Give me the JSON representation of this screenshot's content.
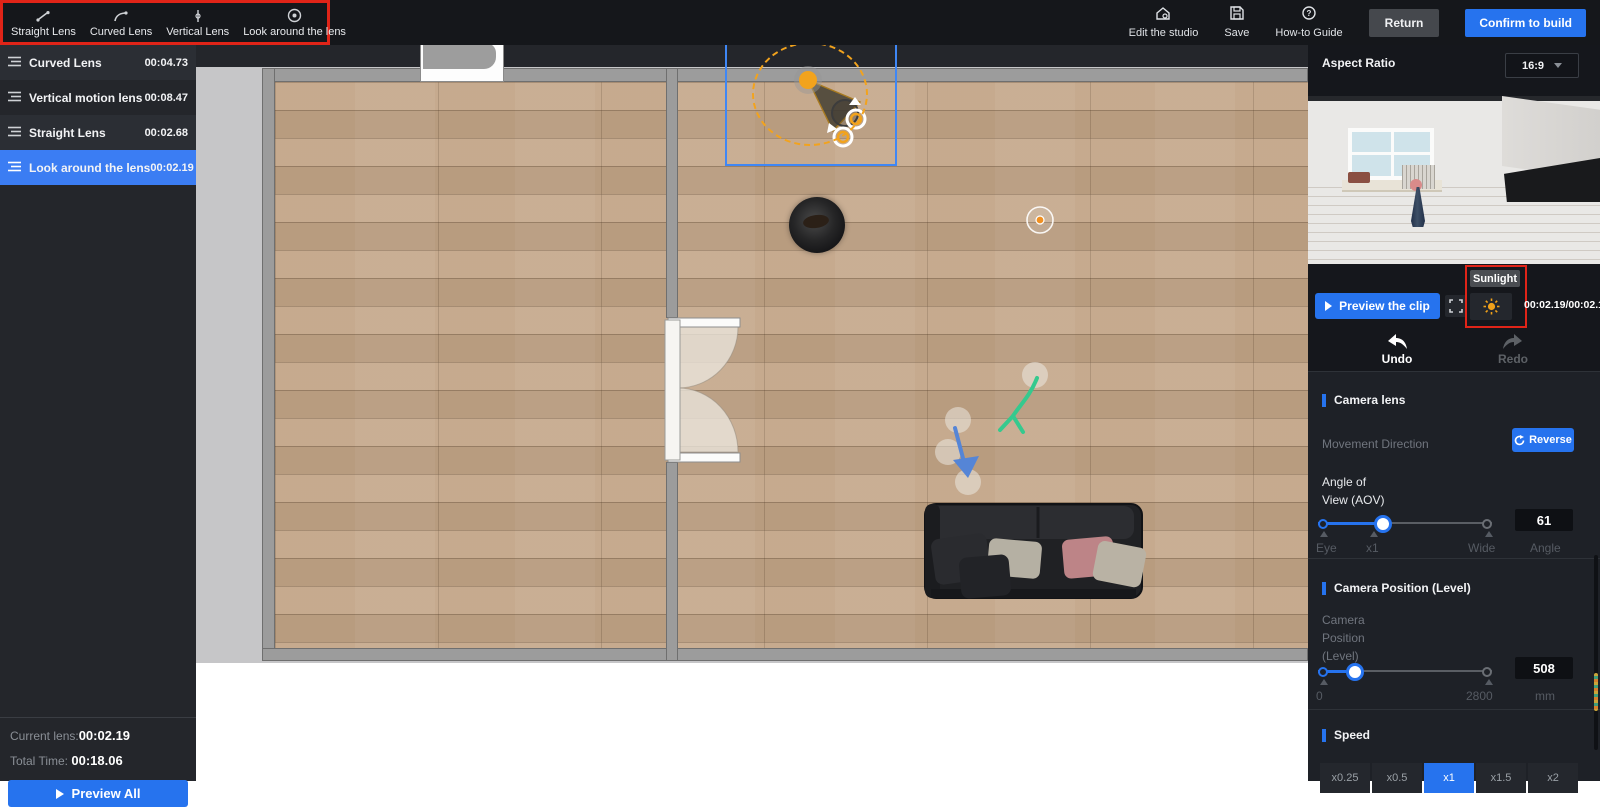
{
  "toolbar": {
    "lens_tools": [
      {
        "label": "Straight Lens"
      },
      {
        "label": "Curved Lens"
      },
      {
        "label": "Vertical Lens"
      },
      {
        "label": "Look around the lens"
      }
    ],
    "actions": [
      {
        "label": "Edit the studio"
      },
      {
        "label": "Save"
      },
      {
        "label": "How-to Guide"
      }
    ],
    "return_label": "Return",
    "confirm_label": "Confirm to build"
  },
  "sidebar": {
    "items": [
      {
        "label": "Curved Lens",
        "time": "00:04.73"
      },
      {
        "label": "Vertical motion lens",
        "time": "00:08.47"
      },
      {
        "label": "Straight Lens",
        "time": "00:02.68"
      },
      {
        "label": "Look around the lens",
        "time": "00:02.19"
      }
    ],
    "current_lens_label": "Current lens:",
    "current_lens_value": "00:02.19",
    "total_time_label": "Total Time:",
    "total_time_value": "00:18.06",
    "preview_all_label": "Preview All"
  },
  "panel": {
    "aspect_ratio_label": "Aspect Ratio",
    "aspect_ratio_value": "16:9",
    "preview_clip_label": "Preview the clip",
    "sunlight_tooltip": "Sunlight",
    "time_display": "00:02.19/00:02.19",
    "undo_label": "Undo",
    "redo_label": "Redo",
    "camera_lens_title": "Camera lens",
    "movement_direction_label": "Movement Direction",
    "reverse_label": "Reverse",
    "aov_label_line1": "Angle of",
    "aov_label_line2": "View (AOV)",
    "aov_min_label": "Eye",
    "aov_mid_label": "x1",
    "aov_max_label": "Wide",
    "aov_value": "61",
    "aov_unit_label": "Angle",
    "camera_position_title": "Camera Position (Level)",
    "camera_position_label_line1": "Camera",
    "camera_position_label_line2": "Position",
    "camera_position_label_line3": "(Level)",
    "camera_position_min": "0",
    "camera_position_max": "2800",
    "camera_position_value": "508",
    "camera_position_unit": "mm",
    "speed_title": "Speed",
    "speed_options": [
      {
        "label": "x0.25"
      },
      {
        "label": "x0.5"
      },
      {
        "label": "x1"
      },
      {
        "label": "x1.5"
      },
      {
        "label": "x2"
      }
    ]
  },
  "colors": {
    "accent_blue": "#2673ee",
    "selected_row_blue": "#3b7df3",
    "highlight_red": "#e02418",
    "sun_orange": "#f0a11a",
    "camera_orange": "#f2a31d"
  }
}
